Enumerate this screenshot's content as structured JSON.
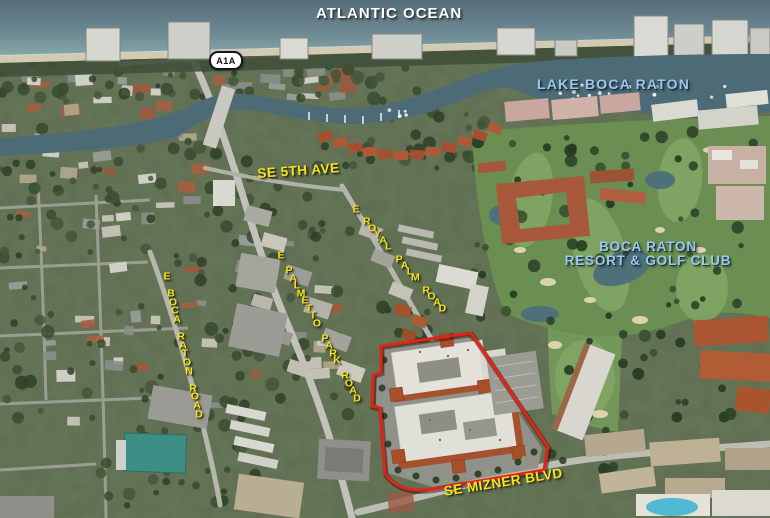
{
  "map": {
    "ocean_label": "ATLANTIC OCEAN",
    "route_shield": "A1A",
    "lake_label": "LAKE BOCA RATON",
    "streets": {
      "se_5th_ave": "SE 5TH AVE",
      "royal_palm": "E ROYAL PALM ROAD",
      "palmetto_park": "E PALMETTO PARK ROAD",
      "boca_raton_rd": "E BOCA RATON ROAD",
      "mizner_blvd": "SE MIZNER BLVD"
    },
    "poi": {
      "resort_line1": "BOCA RATON",
      "resort_line2": "RESORT & GOLF CLUB"
    }
  },
  "colors": {
    "street_label": "#F2E41E",
    "water_label": "#9CC8EA",
    "ocean_label": "#FFFFFF",
    "boundary": "#DE2517"
  }
}
